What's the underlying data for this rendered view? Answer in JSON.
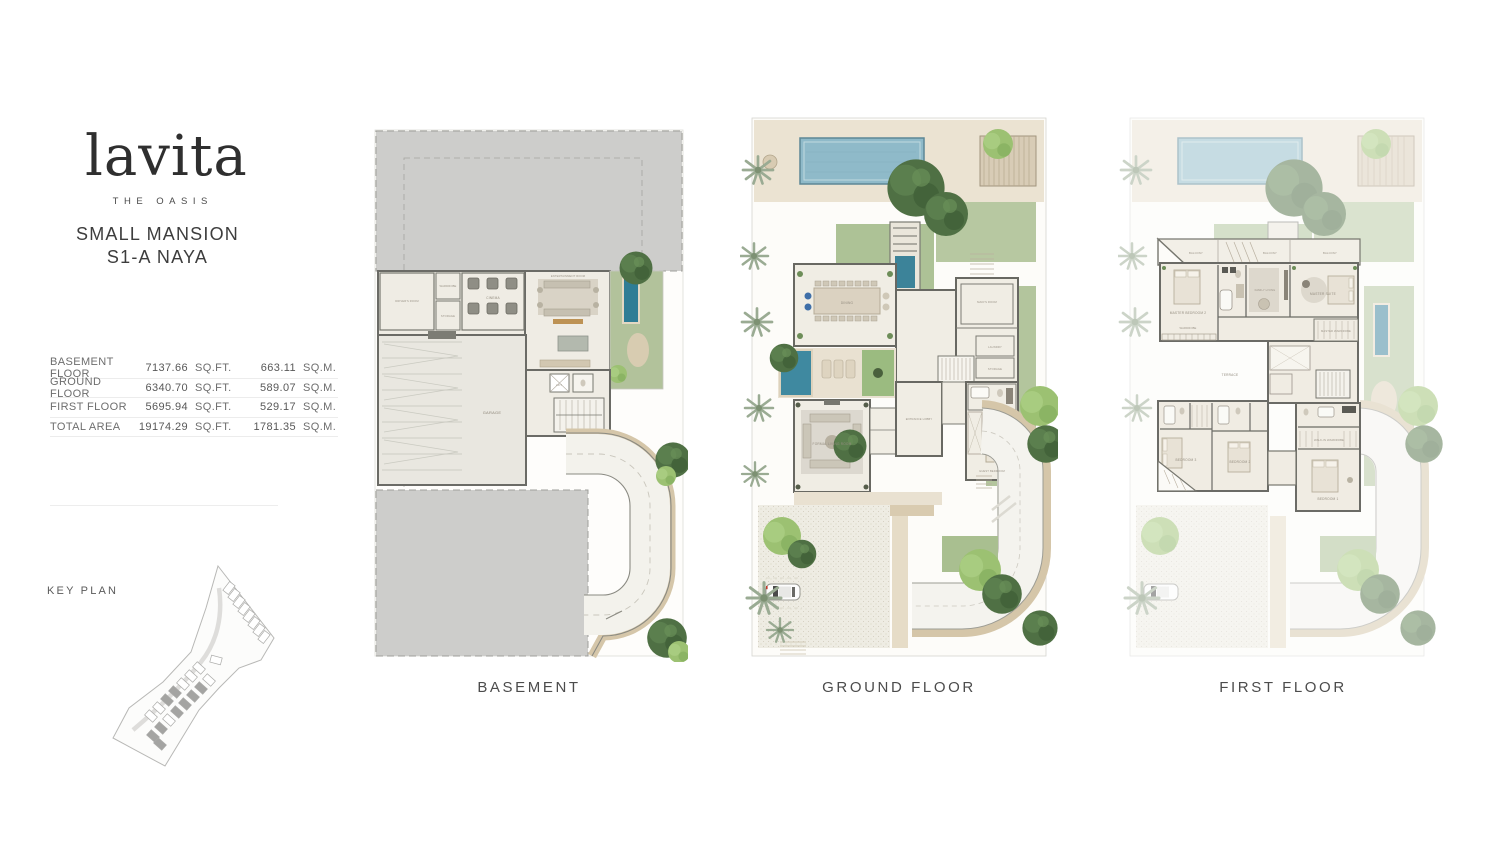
{
  "brand": {
    "logo": "lavita",
    "tagline": "THE OASIS"
  },
  "unit": {
    "type": "SMALL MANSION",
    "code": "S1-A NAYA"
  },
  "area_table": {
    "rows": [
      {
        "label": "BASEMENT FLOOR",
        "sqft": "7137.66",
        "sqft_unit": "SQ.FT.",
        "sqm": "663.11",
        "sqm_unit": "SQ.M."
      },
      {
        "label": "GROUND FLOOR",
        "sqft": "6340.70",
        "sqft_unit": "SQ.FT.",
        "sqm": "589.07",
        "sqm_unit": "SQ.M."
      },
      {
        "label": "FIRST FLOOR",
        "sqft": "5695.94",
        "sqft_unit": "SQ.FT.",
        "sqm": "529.17",
        "sqm_unit": "SQ.M."
      },
      {
        "label": "TOTAL AREA",
        "sqft": "19174.29",
        "sqft_unit": "SQ.FT.",
        "sqm": "1781.35",
        "sqm_unit": "SQ.M."
      }
    ]
  },
  "key_plan": {
    "label": "KEY PLAN"
  },
  "plans": {
    "basement": {
      "caption": "BASEMENT",
      "rooms": {
        "driver": "DRIVER'S ROOM",
        "wardrobe": "WARDROBE",
        "storage": "STORAGE",
        "cinema": "CINEMA",
        "entertainment": "ENTERTAINMENT ROOM",
        "garage": "GARAGE",
        "lift": "LIFT"
      }
    },
    "ground": {
      "caption": "GROUND FLOOR",
      "rooms": {
        "dining": "DINING",
        "maid": "MAID'S ROOM",
        "laundry": "LAUNDRY",
        "storage": "STORAGE",
        "formal_living": "FORMAL LIVING ROOM",
        "lobby": "ENTRANCE LOBBY",
        "guest": "GUEST BEDROOM"
      }
    },
    "first": {
      "caption": "FIRST FLOOR",
      "rooms": {
        "balcony": "BALCONY",
        "master2": "MASTER BEDROOM 2",
        "wardrobe2": "WARDROBE",
        "family": "FAMILY LIVING",
        "master": "MASTER SUITE",
        "master_wardrobe": "MASTER WARDROBE",
        "bed1": "BEDROOM 1",
        "bed2": "BEDROOM 2",
        "bed3": "BEDROOM 3",
        "walkin": "WALK-IN WARDROBE",
        "terrace": "TERRACE"
      }
    }
  },
  "colors": {
    "lap_pool": "#8fbac9",
    "plunge_pool": "#3f89a0",
    "basement_pool": "#2f7d95",
    "lawn": "#adc296",
    "tree_dark": "#4f7044",
    "tree_light": "#9cc172",
    "deck_tan": "#d9cbb2",
    "mass_gray": "#cdcdcb",
    "wall": "#6b6b66",
    "floor_cream": "#f0ede4"
  }
}
